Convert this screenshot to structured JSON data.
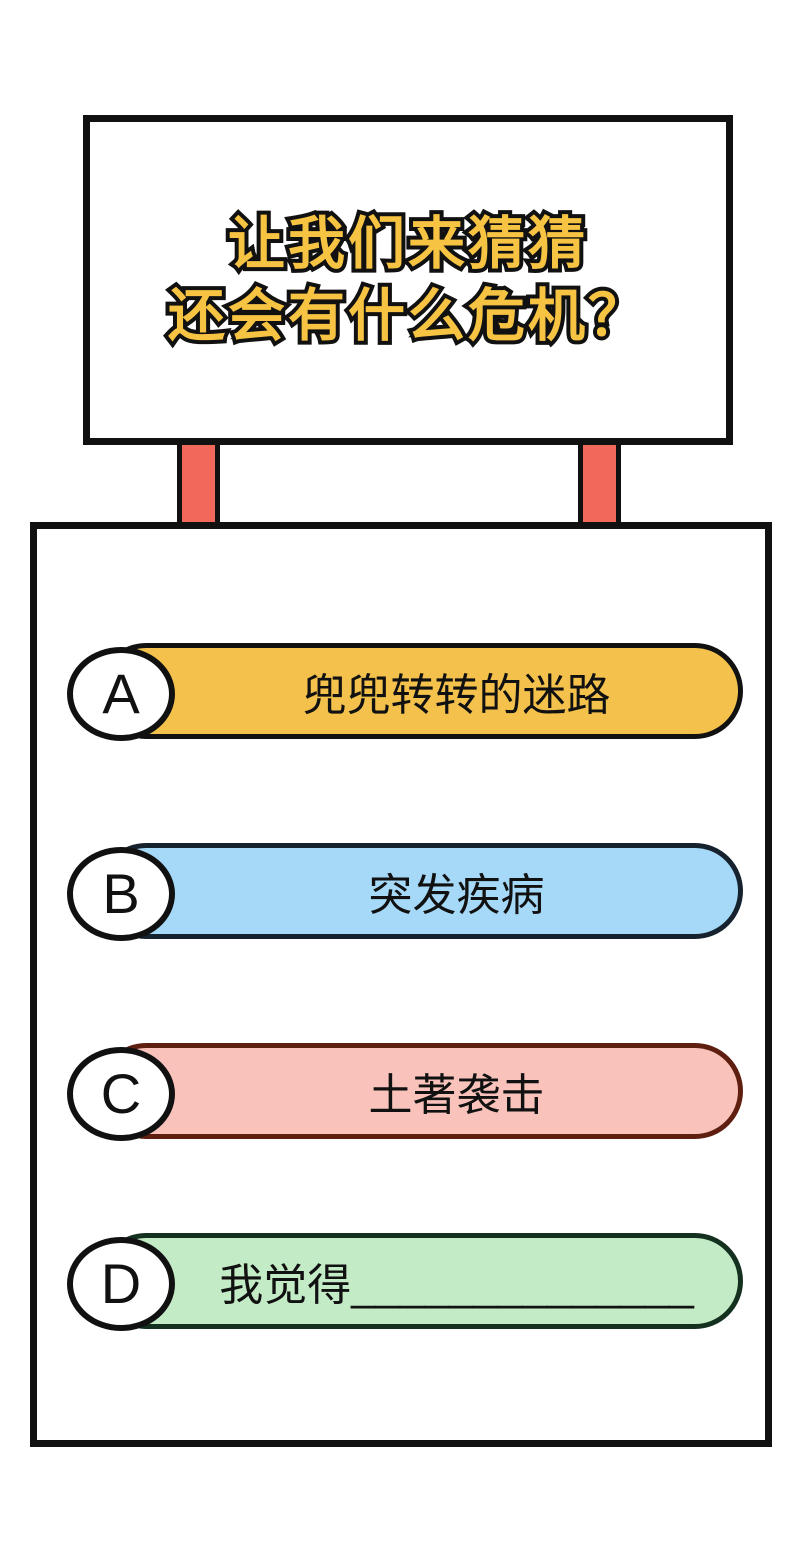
{
  "sign": {
    "title_line1": "让我们来猜猜",
    "title_line2": "还会有什么危机？"
  },
  "options": [
    {
      "letter": "A",
      "label": "兜兜转转的迷路",
      "fill": "#F4C24C",
      "border": "#111111"
    },
    {
      "letter": "B",
      "label": "突发疾病",
      "fill": "#A6D9F7",
      "border": "#16222E"
    },
    {
      "letter": "C",
      "label": "土著袭击",
      "fill": "#F9C3BB",
      "border": "#5F1F10"
    },
    {
      "letter": "D",
      "label": "我觉得______________",
      "fill": "#C3EBC6",
      "border": "#14301F"
    }
  ],
  "colors": {
    "background": "#FFFFFF",
    "outline": "#111111",
    "title_text": "#F6C343",
    "post_fill": "#F2695B",
    "badge_fill": "#FFFFFF"
  }
}
